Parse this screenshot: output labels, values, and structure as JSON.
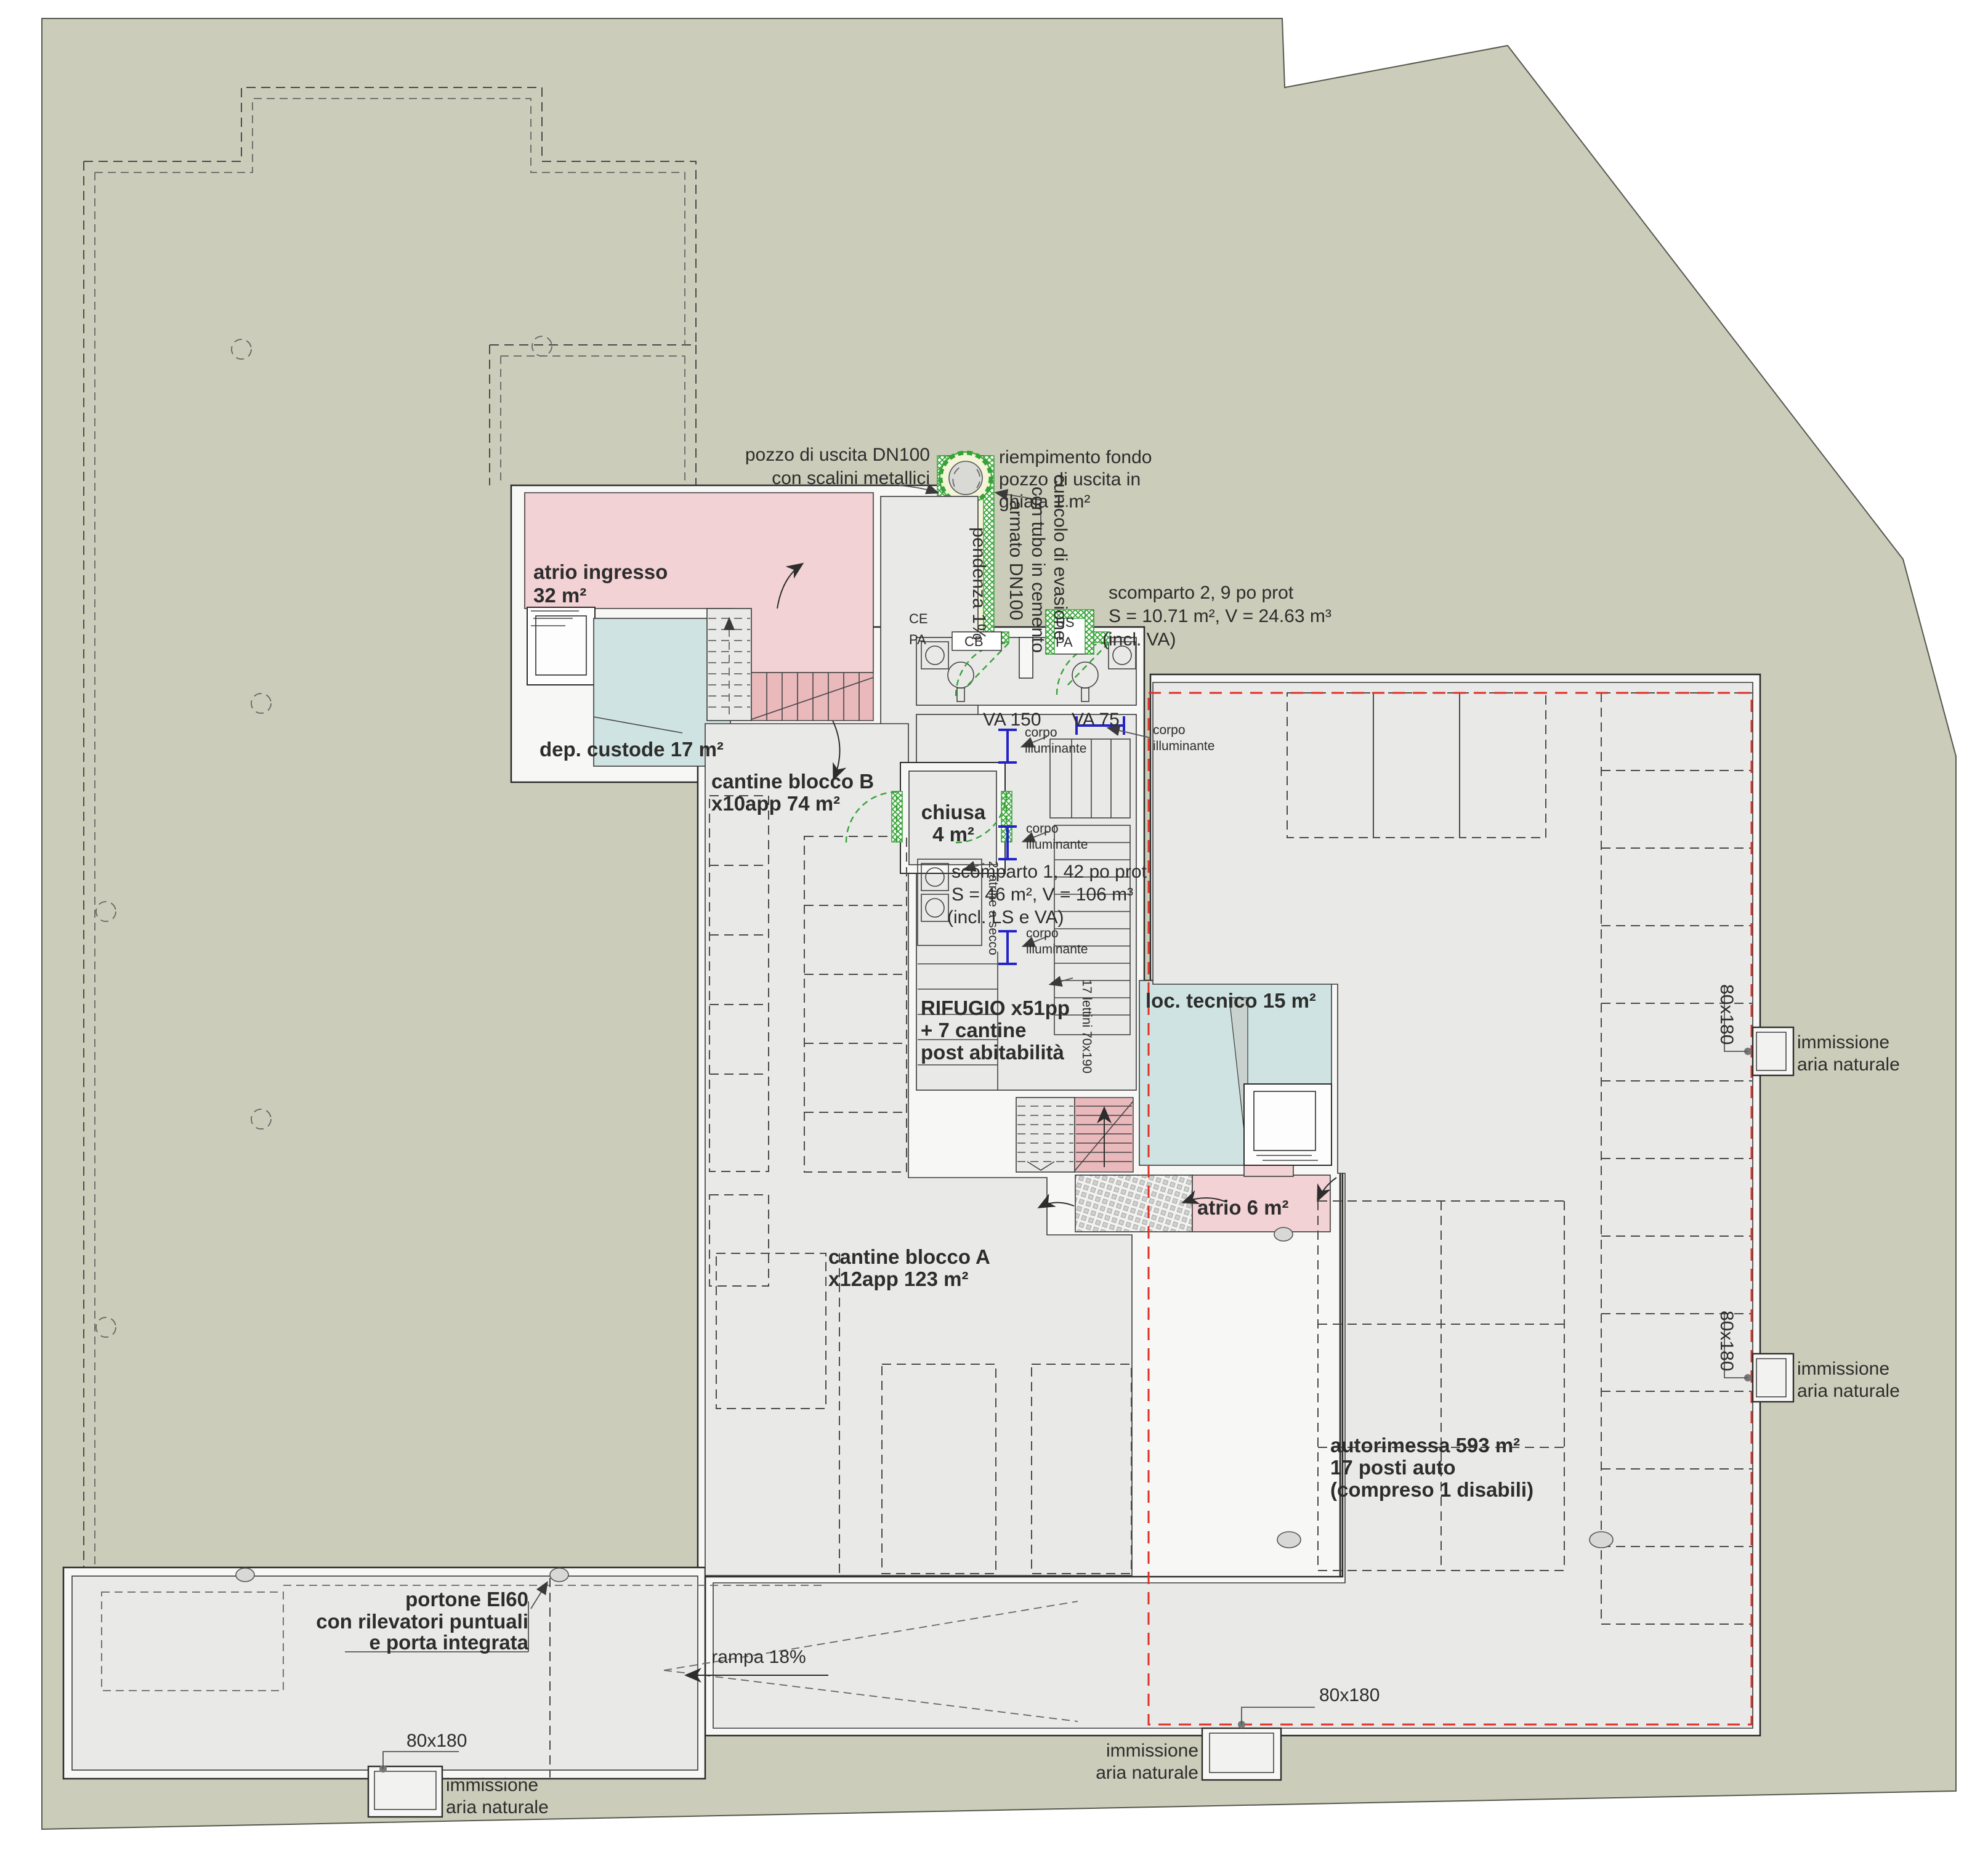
{
  "drawing": {
    "rooms": {
      "atrio_ingresso": {
        "l1": "atrio ingresso",
        "l2": "32 m²"
      },
      "dep_custode": {
        "label": "dep. custode 17 m²"
      },
      "cantine_b": {
        "l1": "cantine blocco B",
        "l2": "x10app 74 m²"
      },
      "chiusa": {
        "l1": "chiusa",
        "l2": "4 m²"
      },
      "rifugio": {
        "l1": "RIFUGIO x51pp",
        "l2": "+ 7 cantine",
        "l3": "post abitabilità"
      },
      "loc_tecnico": {
        "label": "loc. tecnico 15 m²"
      },
      "atrio6": {
        "label": "atrio 6 m²"
      },
      "cantine_a": {
        "l1": "cantine blocco A",
        "l2": "x12app 123 m²"
      },
      "autorimessa": {
        "l1": "autorimessa 593 m²",
        "l2": "17 posti auto",
        "l3": "(compreso 1 disabili)"
      }
    },
    "annotations": {
      "pozzo": {
        "l1": "pozzo di uscita DN100",
        "l2": "con scalini metallici"
      },
      "riempimento": {
        "l1": "riempimento fondo",
        "l2": "pozzo di uscita in",
        "l3": "ghiaia 1 m²"
      },
      "cunicolo": {
        "l1": "cunicolo di evasione",
        "l2": "con tubo in cemento",
        "l3": "armato DN100"
      },
      "pendenza": "pendenza 1%",
      "scomparto2": {
        "l1": "scomparto 2, 9 po prot",
        "l2": "S = 10.71 m², V = 24.63 m³",
        "l3": "(incl. VA)"
      },
      "scomparto1": {
        "l1": "scomparto 1, 42 po prot",
        "l2": "S = 46 m², V = 106 m³",
        "l3": "(incl. LS e VA)"
      },
      "corpo": {
        "l1": "corpo",
        "l2": "illuminante"
      },
      "latrine": "2 latrine a secco",
      "lettini": "17 lettini 70x190",
      "va150": "VA 150",
      "va75": "VA 75",
      "ce": "CE",
      "pa": "PA",
      "us": "US",
      "cb": "CB",
      "portone": {
        "l1": "portone EI60",
        "l2": "con rilevatori puntuali",
        "l3": "e porta integrata"
      },
      "rampa": "rampa 18%",
      "vent": {
        "size": "80x180",
        "l1": "immissione",
        "l2": "aria naturale"
      }
    },
    "colors": {
      "site": "#cbccb9",
      "room_gray": "#e9e9e8",
      "pink": "#f3d2d5",
      "teal": "#cfe4e2",
      "tunnel_yellow": "#f3f4d8",
      "green": "#35a335",
      "red_line": "#e03026",
      "blue_symbol": "#2323c8"
    }
  }
}
